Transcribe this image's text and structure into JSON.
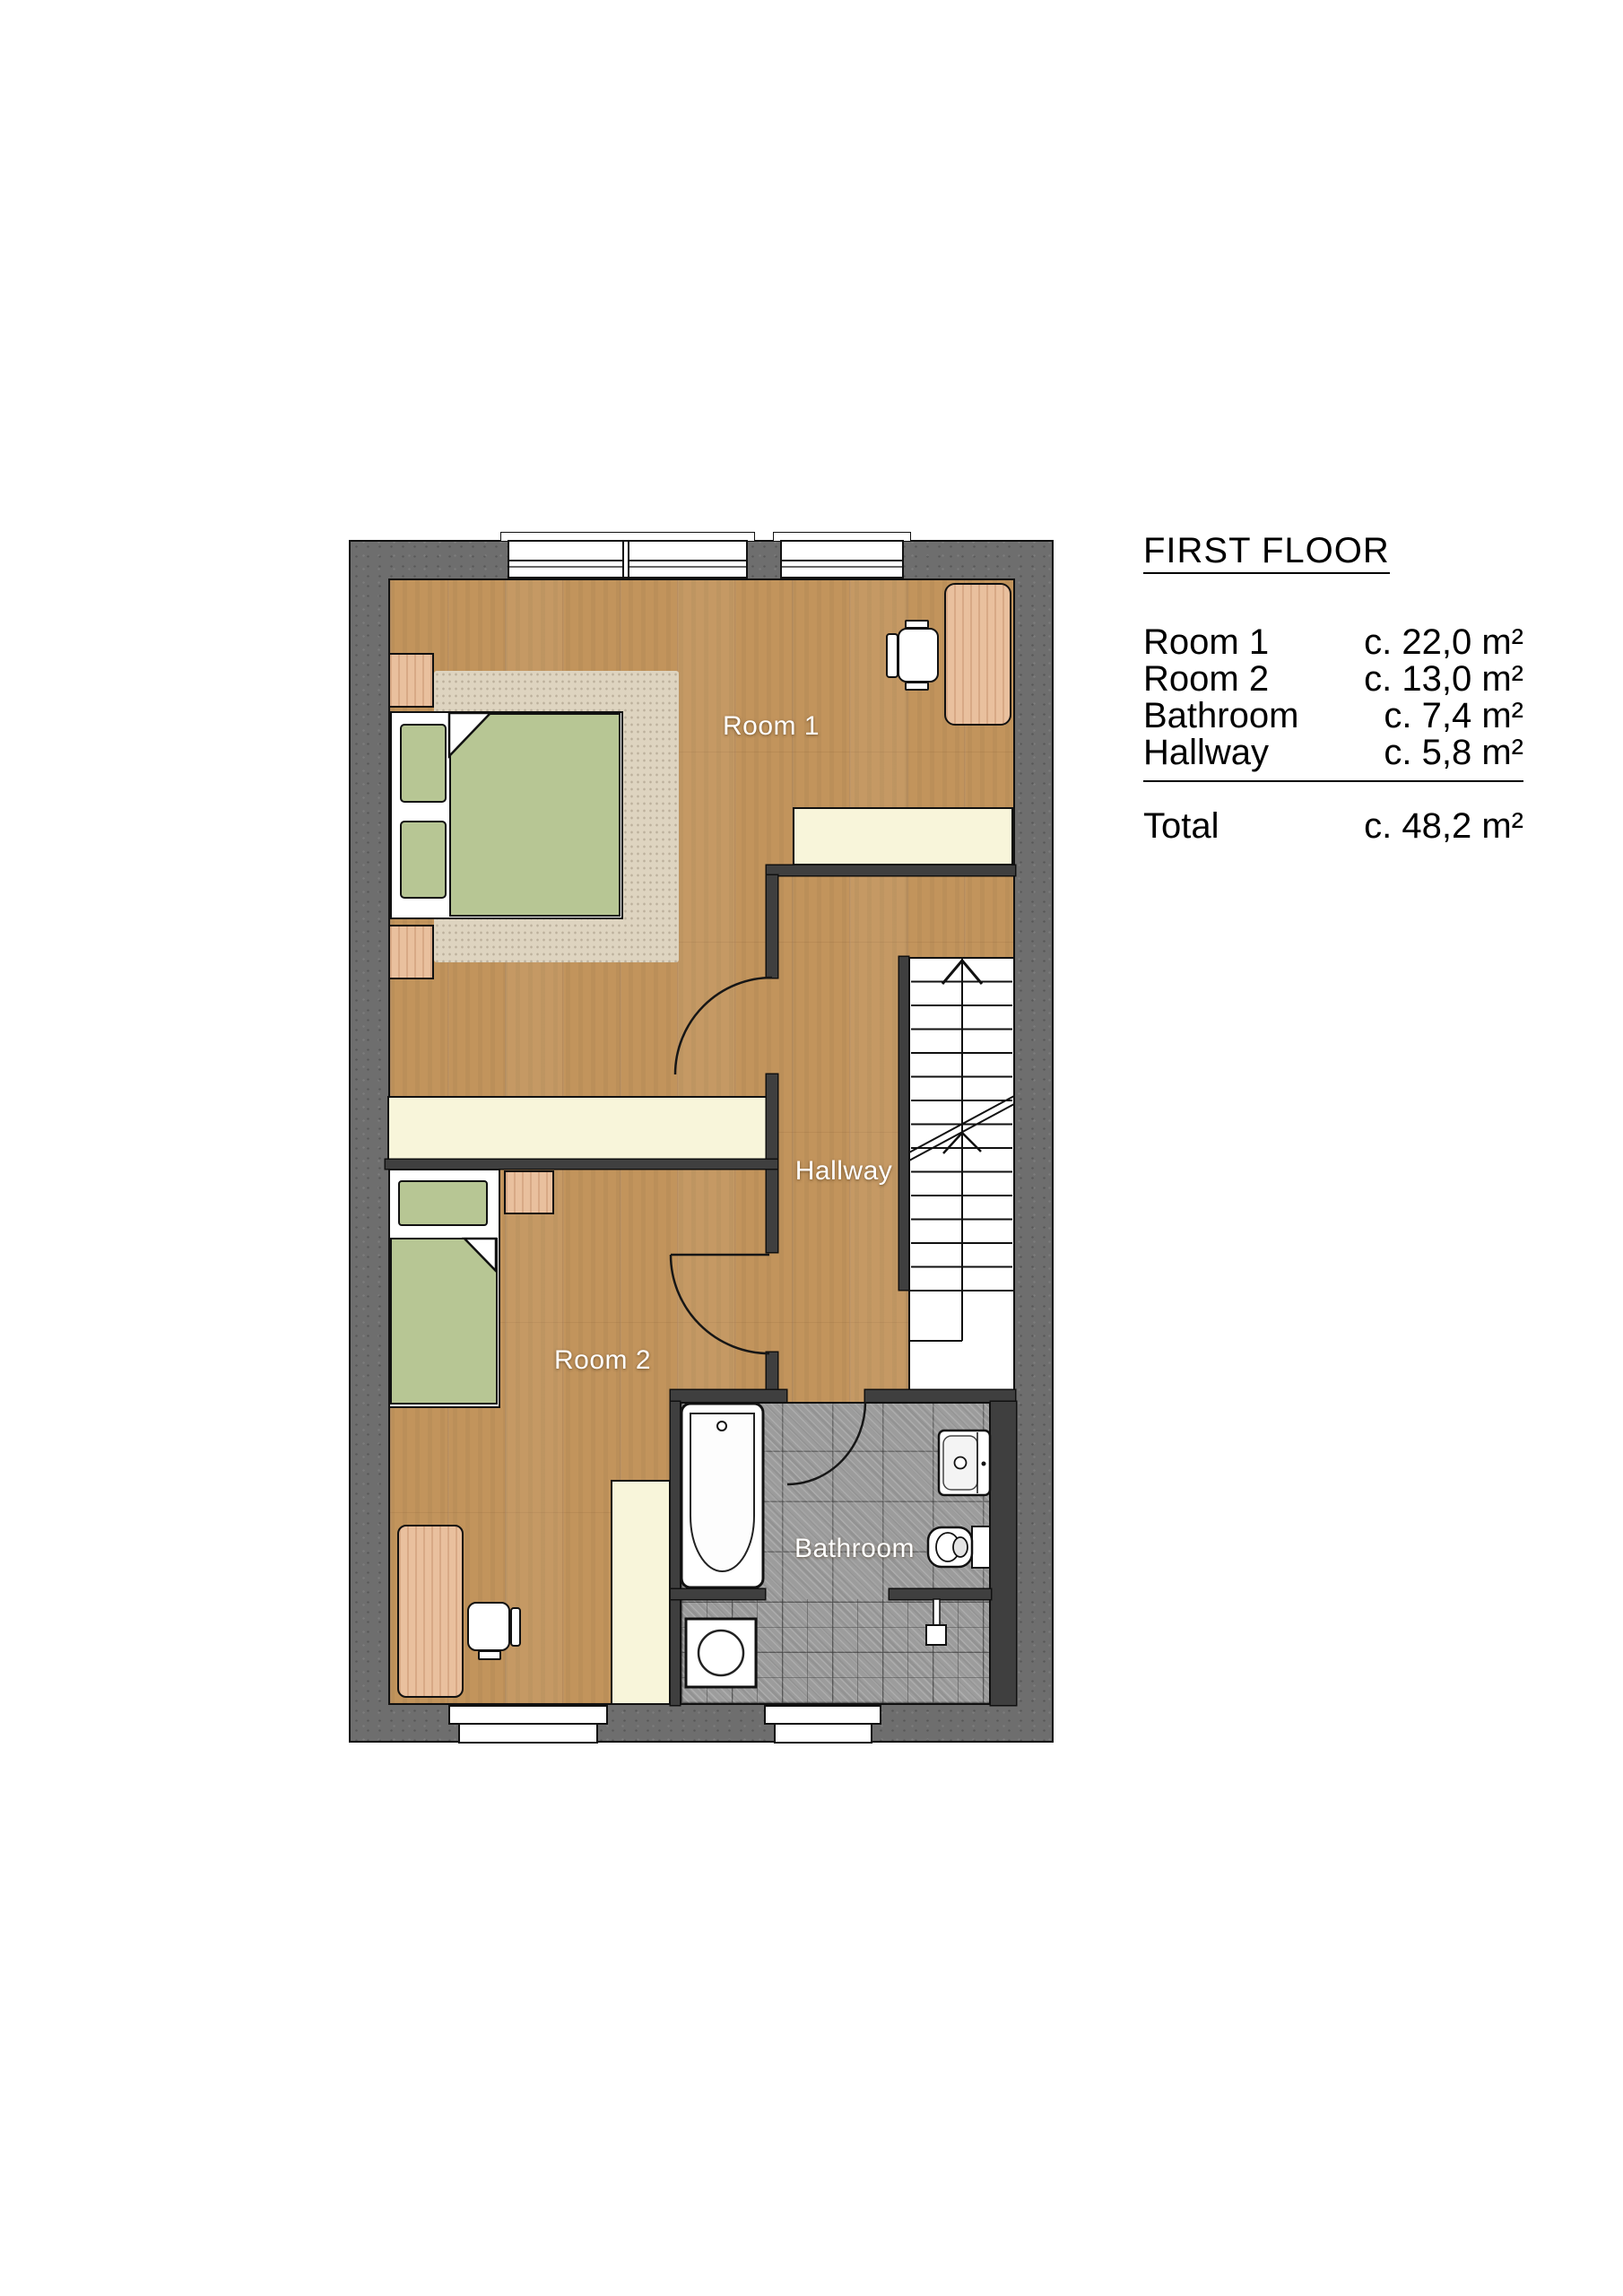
{
  "legend": {
    "title": "FIRST FLOOR",
    "rows": [
      {
        "label": "Room 1",
        "value": "c. 22,0 m²"
      },
      {
        "label": "Room 2",
        "value": "c. 13,0 m²"
      },
      {
        "label": "Bathroom",
        "value": "c. 7,4 m²"
      },
      {
        "label": "Hallway",
        "value": "c. 5,8 m²"
      }
    ],
    "total": {
      "label": "Total",
      "value": "c. 48,2 m²"
    }
  },
  "plan": {
    "labels": {
      "room1": "Room 1",
      "room2": "Room 2",
      "hallway": "Hallway",
      "bathroom": "Bathroom"
    },
    "features": {
      "stairs_direction": "up-arrow",
      "doors": [
        "room1-door",
        "room2-door",
        "bathroom-door"
      ],
      "fixtures": [
        "bathtub",
        "sink",
        "toilet",
        "washing-machine",
        "shower-head"
      ],
      "furniture": [
        "double-bed",
        "single-bed",
        "nightstand",
        "desk",
        "office-chair",
        "wardrobe",
        "rug"
      ]
    }
  },
  "colors": {
    "page_background": "#ffffff",
    "outer_wall": "#6e6e6e",
    "interior_wall": "#3f3f3f",
    "outline": "#111111",
    "wood_floor": "#c2945c",
    "rug": "#ded4c0",
    "wardrobe_cream": "#f8f5da",
    "bed_green": "#b7c694",
    "bathroom_tile": "#9c9c9c",
    "fixture_white": "#ffffff",
    "label_text": "#ffffff",
    "legend_text": "#000000"
  }
}
